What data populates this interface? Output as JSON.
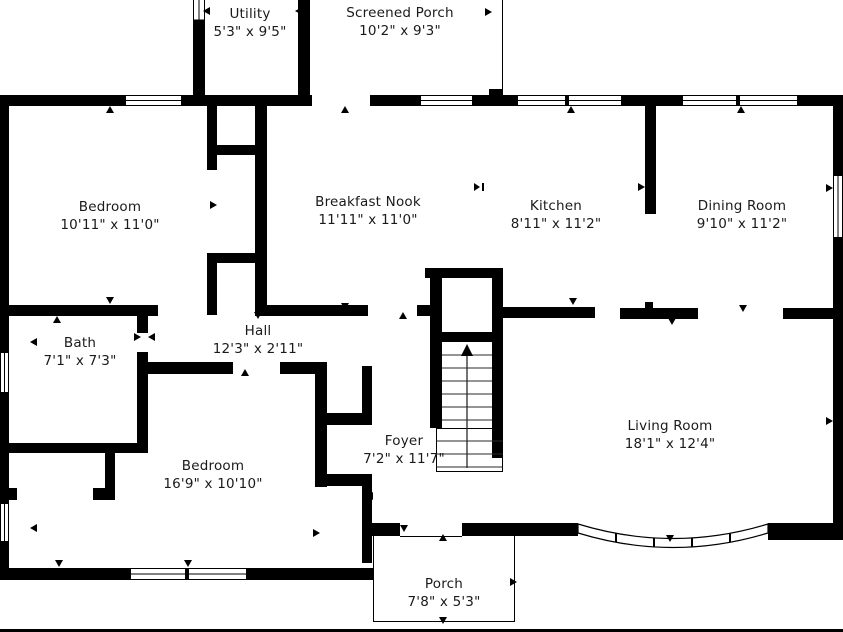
{
  "colors": {
    "walls": "#000000",
    "background": "#ffffff",
    "text": "#1a1a1a"
  },
  "rooms": [
    {
      "name": "Utility",
      "dimensions": "5'3\" x 9'5\""
    },
    {
      "name": "Screened Porch",
      "dimensions": "10'2\" x 9'3\""
    },
    {
      "name": "Bedroom",
      "dimensions": "10'11\" x 11'0\""
    },
    {
      "name": "Breakfast Nook",
      "dimensions": "11'11\" x 11'0\""
    },
    {
      "name": "Kitchen",
      "dimensions": "8'11\" x 11'2\""
    },
    {
      "name": "Dining Room",
      "dimensions": "9'10\" x 11'2\""
    },
    {
      "name": "Bath",
      "dimensions": "7'1\" x 7'3\""
    },
    {
      "name": "Hall",
      "dimensions": "12'3\" x 2'11\""
    },
    {
      "name": "Foyer",
      "dimensions": "7'2\" x 11'7\""
    },
    {
      "name": "Bedroom",
      "dimensions": "16'9\" x 10'10\""
    },
    {
      "name": "Living Room",
      "dimensions": "18'1\" x 12'4\""
    },
    {
      "name": "Porch",
      "dimensions": "7'8\" x 5'3\""
    }
  ]
}
